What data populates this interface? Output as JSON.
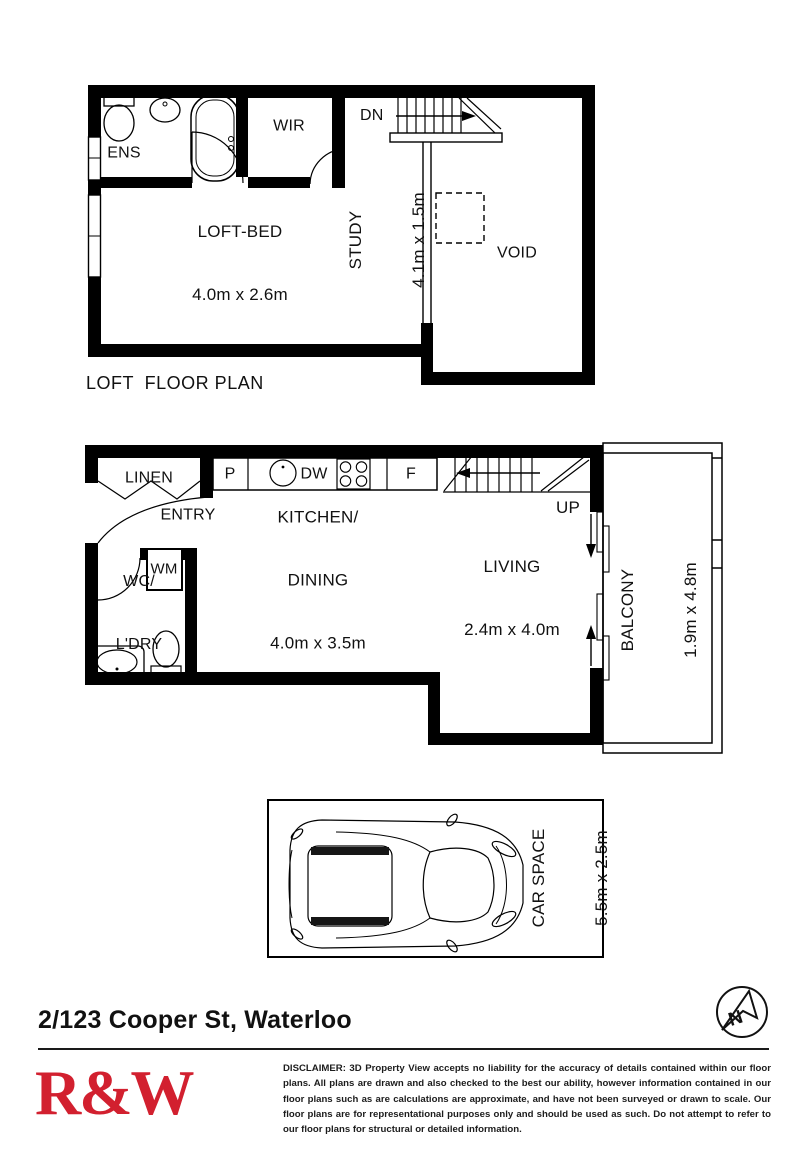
{
  "loft": {
    "caption": "LOFT  FLOOR PLAN",
    "dn": "DN",
    "ens": "ENS",
    "wir": "WIR",
    "loft_bed": [
      "LOFT-BED",
      "4.0m x 2.6m"
    ],
    "study": [
      "STUDY",
      "4.1m x 1.5m"
    ],
    "void": "VOID"
  },
  "main": {
    "linen": "LINEN",
    "entry": "ENTRY",
    "pantry": "P",
    "dishwasher": "DW",
    "fridge": "F",
    "up": "UP",
    "kitchen": [
      "KITCHEN/",
      "DINING",
      "4.0m x 3.5m"
    ],
    "living": [
      "LIVING",
      "2.4m x 4.0m"
    ],
    "washing_machine": "WM",
    "wc": [
      "WC/",
      "L'DRY"
    ],
    "balcony": [
      "BALCONY",
      "1.9m x 4.8m"
    ]
  },
  "car": {
    "label": [
      "CAR SPACE",
      "5.5m x 2.5m"
    ]
  },
  "footer": {
    "address": "2/123 Cooper St, Waterloo",
    "logo": "R&W",
    "logo_color": "#D2202F",
    "compass": "N",
    "disclaimer": "DISCLAIMER: 3D Property View accepts no liability for the accuracy of details contained within our floor plans. All plans are drawn and also checked to the best our ability, however information contained in our floor plans such as are calculations are approximate, and have not been surveyed or drawn to scale. Our floor plans are for representational purposes only and should be used as such. Do not attempt to refer to our floor plans for structural or detailed information."
  }
}
